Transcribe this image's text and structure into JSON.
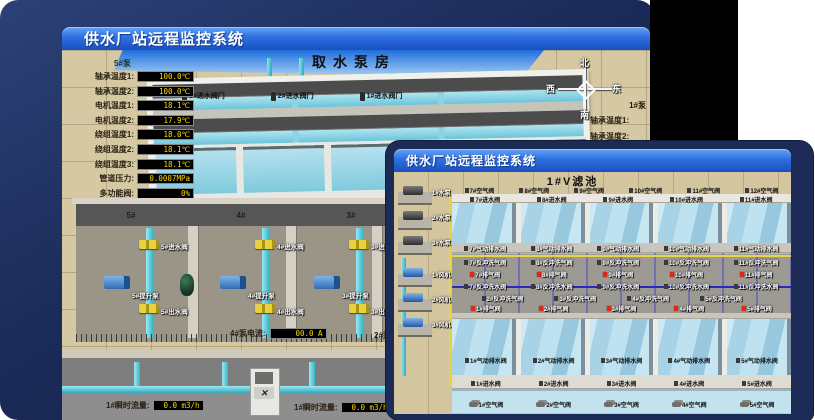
{
  "window1": {
    "title": "供水厂站远程监控系统",
    "scene_title": "取水泵房",
    "pump_panel": {
      "title": "5#泵",
      "rows": [
        {
          "label": "轴承温度1:",
          "value": "100.0℃"
        },
        {
          "label": "轴承温度2:",
          "value": "100.0℃"
        },
        {
          "label": "电机温度1:",
          "value": "18.1℃"
        },
        {
          "label": "电机温度2:",
          "value": "17.9℃"
        },
        {
          "label": "绕组温度1:",
          "value": "18.0℃"
        },
        {
          "label": "绕组温度2:",
          "value": "18.1℃"
        },
        {
          "label": "绕组温度3:",
          "value": "18.1℃"
        },
        {
          "label": "管道压力:",
          "value": "0.0007MPa"
        },
        {
          "label": "多功能阀:",
          "value": "0%"
        }
      ]
    },
    "right_panel": {
      "title": "1#泵",
      "labels": [
        "轴承温度1:",
        "轴承温度2:"
      ]
    },
    "compass": {
      "north": "北",
      "south": "南",
      "east": "东",
      "west": "西"
    },
    "inlet_valves": [
      "3#进水阀门",
      "2#进水阀门",
      "1#进水阀门"
    ],
    "bay_labels": [
      "5#",
      "4#",
      "3#",
      "2#"
    ],
    "pump_units": [
      {
        "inlet": "5#进水阀",
        "pump": "5#提升泵",
        "outlet": "5#出水阀"
      },
      {
        "inlet": "4#进水阀",
        "pump": "4#提升泵",
        "outlet": "4#出水阀"
      },
      {
        "inlet": "3#进水阀",
        "pump": "3#提升泵",
        "outlet": "3#出水阀"
      }
    ],
    "current_readout": {
      "label": "4#泵电流:",
      "value": "00.0 A"
    },
    "current_readout_partial": "2#泵电流",
    "flow_readouts": [
      {
        "label": "1#瞬时流量:",
        "value": "0.0 m3/h"
      },
      {
        "label": "1#瞬时流量:",
        "value": "0.0 m3/h"
      }
    ]
  },
  "window2": {
    "title": "供水厂站远程监控系统",
    "scene_title": "1#V滤池",
    "pumps": [
      "1#水泵",
      "2#水泵",
      "3#水泵"
    ],
    "blowers": [
      "1#风机",
      "2#风机",
      "3#风机"
    ],
    "rows": {
      "air_valves_top": [
        "7#空气阀",
        "8#空气阀",
        "9#空气阀",
        "10#空气阀",
        "11#空气阀",
        "12#空气阀"
      ],
      "inlet_valves_top": [
        "7#进水阀",
        "8#进水阀",
        "9#进水阀",
        "10#进水阀",
        "11#进水阀"
      ],
      "drain_valves_top": [
        "7#气动排水阀",
        "8#气动排水阀",
        "9#气动排水阀",
        "10#气动排水阀",
        "11#气动排水阀"
      ],
      "backwash_air_valves": [
        "7#反冲洗气阀",
        "8#反冲洗气阀",
        "9#反冲洗气阀",
        "10#反冲洗气阀",
        "11#反冲洗气阀"
      ],
      "exhaust_valves_upper": [
        "7#排气阀",
        "8#排气阀",
        "9#排气阀",
        "10#排气阀",
        "11#排气阀"
      ],
      "backwash_water_valves": [
        "7#反冲洗水阀",
        "8#反冲洗水阀",
        "9#反冲洗水阀",
        "10#反冲洗水阀",
        "11#反冲洗水阀"
      ],
      "backwash_air_valves_lower": [
        "2#反冲洗气阀",
        "3#反冲洗气阀",
        "4#反冲洗气阀",
        "5#反冲洗气阀"
      ],
      "exhaust_valves_lower": [
        "1#排气阀",
        "2#排气阀",
        "3#排气阀",
        "4#排气阀",
        "5#排气阀"
      ],
      "drain_valves_bottom": [
        "1#气动排水阀",
        "2#气动排水阀",
        "3#气动排水阀",
        "4#气动排水阀",
        "5#气动排水阀"
      ],
      "inlet_valves_bottom": [
        "1#进水阀",
        "2#进水阀",
        "3#进水阀",
        "4#进水阀",
        "5#进水阀"
      ],
      "air_valves_bottom": [
        "1#空气阀",
        "2#空气阀",
        "3#空气阀",
        "4#空气阀",
        "5#空气阀"
      ]
    }
  },
  "colors": {
    "titlebar_blue_top": "#66a4f4",
    "titlebar_blue_bottom": "#1a4fbe",
    "desktop_navy": "#1b2b58",
    "lcd_background": "#000000",
    "lcd_text_yellow": "#ffd800",
    "alarm_red": "#e02818",
    "pipe_cyan": "#37b6ca",
    "pool_water_blue": "#a8d2e6",
    "ground_tan": "#d5c8a2"
  }
}
